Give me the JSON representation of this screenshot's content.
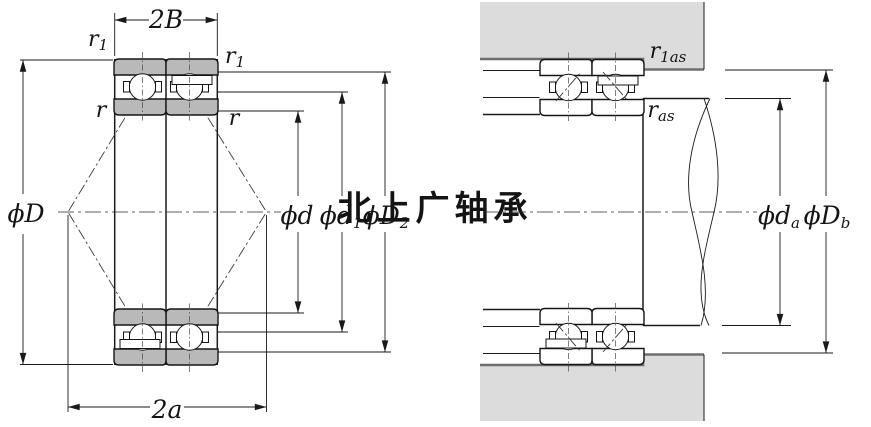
{
  "watermark": {
    "text": "北上广轴承"
  },
  "left_figure": {
    "labels": {
      "dim_width_2B": {
        "main": "2B"
      },
      "r1_left": {
        "main": "r",
        "sub": "1"
      },
      "r1_right": {
        "main": "r",
        "sub": "1"
      },
      "r_left": {
        "main": "r"
      },
      "r_right": {
        "main": "r"
      },
      "outer_diameter_D": {
        "main": "ϕD"
      },
      "bore_diameter_d": {
        "main": "ϕd"
      },
      "shoulder_d1": {
        "main": "ϕd",
        "sub": "1"
      },
      "shoulder_D2": {
        "main": "ϕD",
        "sub": "2"
      },
      "dim_span_2a": {
        "main": "2a"
      }
    }
  },
  "right_figure": {
    "labels": {
      "fillet_r1as": {
        "main": "r",
        "sub": "1as"
      },
      "fillet_ras": {
        "main": "r",
        "sub": "as"
      },
      "abutment_da": {
        "main": "ϕd",
        "sub": "a"
      },
      "abutment_Db": {
        "main": "ϕD",
        "sub": "b"
      }
    }
  },
  "colors": {
    "ring_fill": "#b9b9b9",
    "housing_fill": "#dcdcdc",
    "line": "#1a1a1a",
    "watermark": "#e2e2e2"
  }
}
